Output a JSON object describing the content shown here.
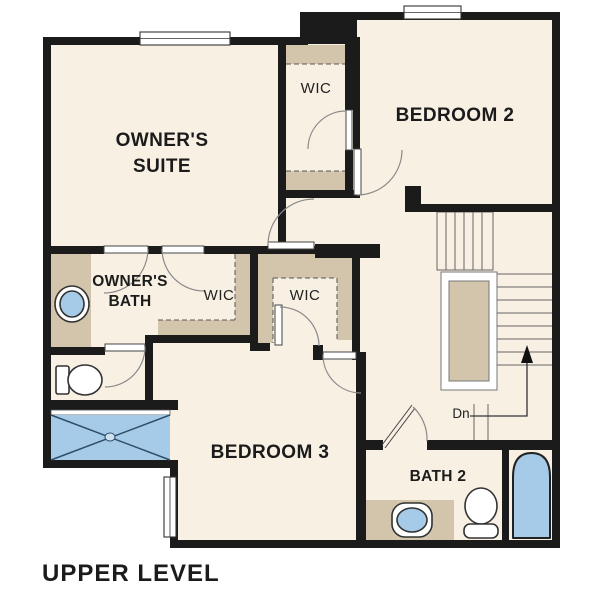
{
  "plan": {
    "title": "UPPER LEVEL",
    "labels": {
      "owners_suite_1": "OWNER'S",
      "owners_suite_2": "SUITE",
      "bedroom_2": "BEDROOM 2",
      "bedroom_3": "BEDROOM 3",
      "owners_bath_1": "OWNER'S",
      "owners_bath_2": "BATH",
      "bath_2": "BATH 2",
      "wic_top": "WIC",
      "wic_owners": "WIC",
      "wic_hall": "WIC",
      "stairs_direction": "Dn"
    },
    "colors": {
      "background": "#ffffff",
      "floor": "#f8f0e3",
      "wall": "#1b1b1b",
      "cabinetry": "#d2c5ac",
      "fixture_blue": "#a6cbe9"
    }
  }
}
